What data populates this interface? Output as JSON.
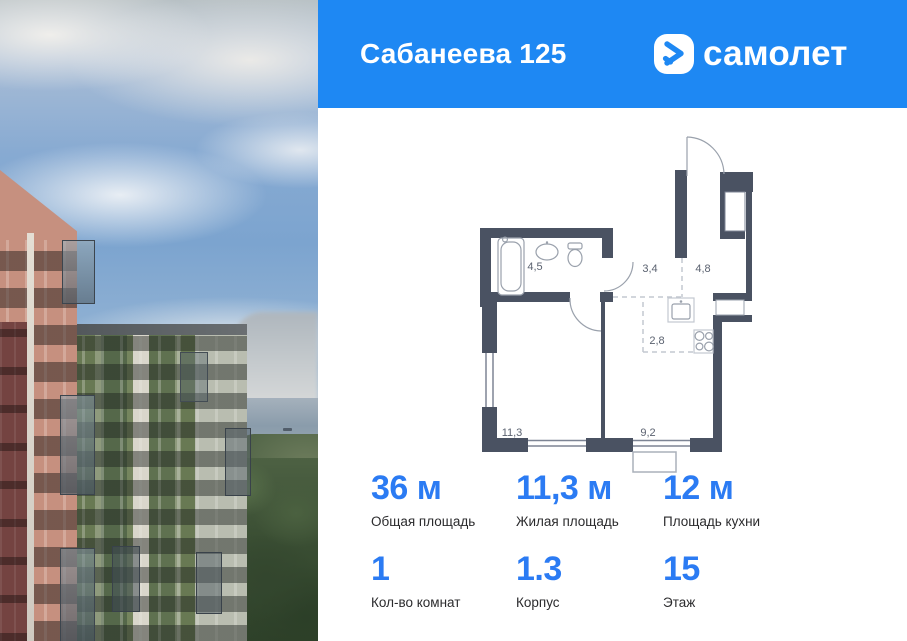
{
  "header": {
    "title": "Сабанеева 125",
    "brand": "самолет"
  },
  "floorplan": {
    "rooms": [
      {
        "name": "bathroom",
        "area": "4,5"
      },
      {
        "name": "hallway",
        "area": "3,4"
      },
      {
        "name": "entrance-room",
        "area": "4,8"
      },
      {
        "name": "kitchen-zone",
        "area": "2,8"
      },
      {
        "name": "living-room",
        "area": "11,3"
      },
      {
        "name": "kitchen-living",
        "area": "9,2"
      }
    ]
  },
  "stats": {
    "cells": [
      {
        "value": "36 м",
        "label": "Общая площадь"
      },
      {
        "value": "11,3 м",
        "label": "Жилая площадь"
      },
      {
        "value": "12 м",
        "label": "Площадь кухни"
      },
      {
        "value": "1",
        "label": "Кол-во комнат"
      },
      {
        "value": "1.3",
        "label": "Корпус"
      },
      {
        "value": "15",
        "label": "Этаж"
      }
    ]
  },
  "colors": {
    "header_blue": "#1e88f3",
    "accent_blue": "#2b7bf3",
    "wall_color": "#4a5262"
  }
}
